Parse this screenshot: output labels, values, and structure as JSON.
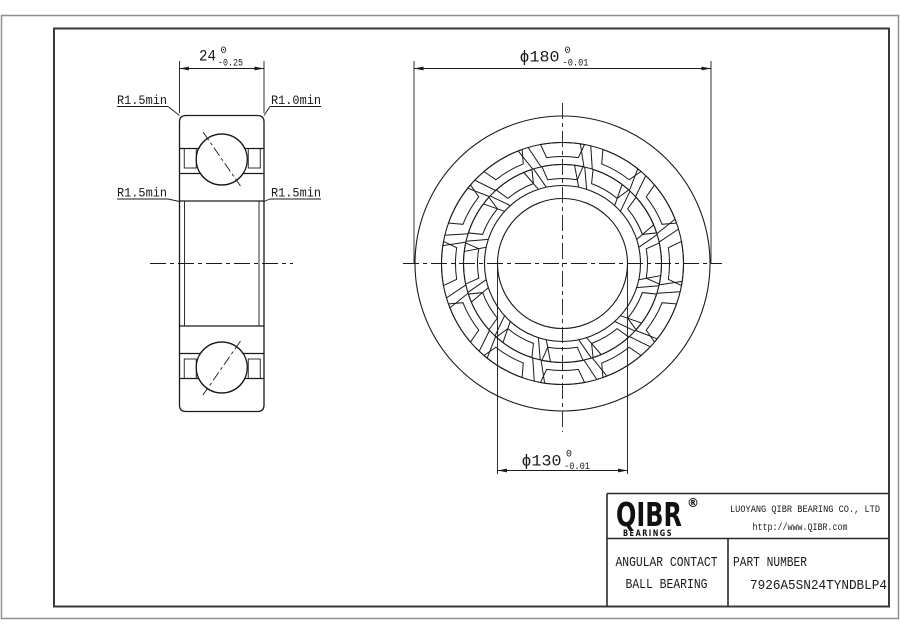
{
  "colors": {
    "line": "#1a1a1a",
    "frame": "#3a3a3a",
    "page_border": "#8f8f8f",
    "background": "#ffffff"
  },
  "drawing": {
    "section_view": {
      "width_dim": {
        "value": "24",
        "tol_upper": "0",
        "tol_lower": "-0.25"
      },
      "callouts": {
        "top_left": "R1.5min",
        "top_right": "R1.0min",
        "mid_left": "R1.5min",
        "mid_right": "R1.5min"
      }
    },
    "front_view": {
      "od_dim": {
        "value": "ϕ180",
        "tol_upper": "0",
        "tol_lower": "-0.01"
      },
      "bore_dim": {
        "value": "ϕ130",
        "tol_upper": "0",
        "tol_lower": "-0.01"
      }
    }
  },
  "title_block": {
    "brand": {
      "name": "QIBR",
      "registered_mark": "®",
      "tagline": "BEARINGS"
    },
    "company_name": "LUOYANG QIBR BEARING CO., LTD",
    "website": "http://www.QIBR.com",
    "product": {
      "line1": "ANGULAR CONTACT",
      "line2": "BALL BEARING"
    },
    "part_number_label": "PART NUMBER",
    "part_number": "7926A5SN24TYNDBLP4"
  }
}
